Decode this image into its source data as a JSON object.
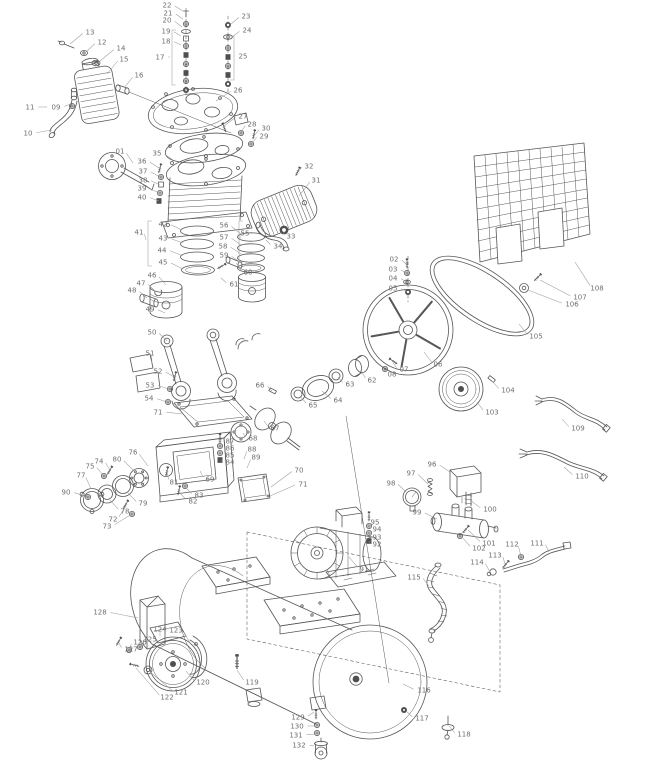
{
  "diagram": {
    "type": "exploded-parts-diagram",
    "background": "#ffffff",
    "line_color": "#565656",
    "label_color": "#6e6e6e"
  },
  "callouts": [
    {
      "n": "01",
      "lx": 120,
      "ly": 151,
      "tx": 133,
      "ty": 163
    },
    {
      "n": "02",
      "lx": 394,
      "ly": 259,
      "tx": 406,
      "ty": 264
    },
    {
      "n": "03",
      "lx": 393,
      "ly": 269,
      "tx": 406,
      "ty": 273
    },
    {
      "n": "04",
      "lx": 393,
      "ly": 278,
      "tx": 407,
      "ty": 282
    },
    {
      "n": "05",
      "lx": 393,
      "ly": 288,
      "tx": 407,
      "ty": 292
    },
    {
      "n": "06",
      "lx": 438,
      "ly": 364,
      "tx": 424,
      "ty": 352
    },
    {
      "n": "07",
      "lx": 404,
      "ly": 369,
      "tx": 393,
      "ty": 363
    },
    {
      "n": "08",
      "lx": 392,
      "ly": 374,
      "tx": 385,
      "ty": 369
    },
    {
      "n": "09",
      "lx": 56,
      "ly": 107,
      "tx": 71,
      "ty": 104
    },
    {
      "n": "10",
      "lx": 28,
      "ly": 133,
      "tx": 52,
      "ty": 130
    },
    {
      "n": "11",
      "lx": 30,
      "ly": 107,
      "tx": 47,
      "ty": 107
    },
    {
      "n": "12",
      "lx": 102,
      "ly": 42,
      "tx": 86,
      "ty": 52
    },
    {
      "n": "13",
      "lx": 90,
      "ly": 32,
      "tx": 70,
      "ty": 44
    },
    {
      "n": "14",
      "lx": 121,
      "ly": 48,
      "tx": 100,
      "ty": 61
    },
    {
      "n": "15",
      "lx": 124,
      "ly": 59,
      "tx": 107,
      "ty": 74
    },
    {
      "n": "16",
      "lx": 139,
      "ly": 75,
      "tx": 124,
      "ty": 88
    },
    {
      "n": "17",
      "lx": 160,
      "ly": 57,
      "tx": 170,
      "ty": 57
    },
    {
      "n": "18",
      "lx": 166,
      "ly": 41,
      "tx": 181,
      "ty": 45
    },
    {
      "n": "19",
      "lx": 166,
      "ly": 31,
      "tx": 181,
      "ty": 36
    },
    {
      "n": "20",
      "lx": 167,
      "ly": 20,
      "tx": 182,
      "ty": 27
    },
    {
      "n": "21",
      "lx": 168,
      "ly": 13,
      "tx": 183,
      "ty": 19
    },
    {
      "n": "22",
      "lx": 167,
      "ly": 5,
      "tx": 183,
      "ty": 11
    },
    {
      "n": "23",
      "lx": 246,
      "ly": 16,
      "tx": 230,
      "ty": 25
    },
    {
      "n": "24",
      "lx": 247,
      "ly": 30,
      "tx": 231,
      "ty": 38
    },
    {
      "n": "25",
      "lx": 243,
      "ly": 56,
      "tx": 235,
      "ty": 56
    },
    {
      "n": "26",
      "lx": 238,
      "ly": 90,
      "tx": 216,
      "ty": 101
    },
    {
      "n": "27",
      "lx": 243,
      "ly": 116,
      "tx": 224,
      "ty": 126
    },
    {
      "n": "28",
      "lx": 252,
      "ly": 124,
      "tx": 241,
      "ty": 132
    },
    {
      "n": "29",
      "lx": 264,
      "ly": 136,
      "tx": 252,
      "ty": 143
    },
    {
      "n": "30",
      "lx": 266,
      "ly": 128,
      "tx": 254,
      "ty": 136
    },
    {
      "n": "31",
      "lx": 316,
      "ly": 180,
      "tx": 299,
      "ty": 196
    },
    {
      "n": "32",
      "lx": 309,
      "ly": 166,
      "tx": 298,
      "ty": 172
    },
    {
      "n": "33",
      "lx": 291,
      "ly": 236,
      "tx": 284,
      "ty": 232
    },
    {
      "n": "34",
      "lx": 278,
      "ly": 246,
      "tx": 266,
      "ty": 240
    },
    {
      "n": "35",
      "lx": 157,
      "ly": 153,
      "tx": 173,
      "ty": 160
    },
    {
      "n": "36",
      "lx": 142,
      "ly": 161,
      "tx": 159,
      "ty": 168
    },
    {
      "n": "37",
      "lx": 143,
      "ly": 171,
      "tx": 160,
      "ty": 177
    },
    {
      "n": "38",
      "lx": 143,
      "ly": 180,
      "tx": 160,
      "ty": 185
    },
    {
      "n": "39",
      "lx": 142,
      "ly": 188,
      "tx": 159,
      "ty": 193
    },
    {
      "n": "40",
      "lx": 142,
      "ly": 197,
      "tx": 159,
      "ty": 201
    },
    {
      "n": "41",
      "lx": 139,
      "ly": 232,
      "tx": 146,
      "ty": 240
    },
    {
      "n": "42",
      "lx": 163,
      "ly": 224,
      "tx": 182,
      "ty": 230
    },
    {
      "n": "43",
      "lx": 163,
      "ly": 238,
      "tx": 183,
      "ty": 243
    },
    {
      "n": "44",
      "lx": 162,
      "ly": 250,
      "tx": 183,
      "ty": 256
    },
    {
      "n": "45",
      "lx": 163,
      "ly": 262,
      "tx": 183,
      "ty": 269
    },
    {
      "n": "46",
      "lx": 152,
      "ly": 275,
      "tx": 166,
      "ty": 285
    },
    {
      "n": "47",
      "lx": 141,
      "ly": 283,
      "tx": 156,
      "ty": 292
    },
    {
      "n": "48",
      "lx": 132,
      "ly": 290,
      "tx": 147,
      "ty": 298
    },
    {
      "n": "49",
      "lx": 150,
      "ly": 309,
      "tx": 165,
      "ty": 313
    },
    {
      "n": "50",
      "lx": 152,
      "ly": 332,
      "tx": 167,
      "ty": 341
    },
    {
      "n": "51",
      "lx": 150,
      "ly": 353,
      "tx": 152,
      "ty": 363
    },
    {
      "n": "52",
      "lx": 158,
      "ly": 371,
      "tx": 174,
      "ty": 377
    },
    {
      "n": "53",
      "lx": 150,
      "ly": 385,
      "tx": 169,
      "ty": 389
    },
    {
      "n": "54",
      "lx": 149,
      "ly": 398,
      "tx": 167,
      "ty": 402
    },
    {
      "n": "55",
      "lx": 245,
      "ly": 233,
      "tx": 240,
      "ty": 240
    },
    {
      "n": "56",
      "lx": 224,
      "ly": 225,
      "tx": 241,
      "ty": 234
    },
    {
      "n": "57",
      "lx": 224,
      "ly": 237,
      "tx": 241,
      "ty": 245
    },
    {
      "n": "58",
      "lx": 223,
      "ly": 246,
      "tx": 241,
      "ty": 254
    },
    {
      "n": "59",
      "lx": 224,
      "ly": 255,
      "tx": 241,
      "ty": 263
    },
    {
      "n": "60",
      "lx": 248,
      "ly": 272,
      "tx": 236,
      "ty": 263
    },
    {
      "n": "61",
      "lx": 234,
      "ly": 284,
      "tx": 221,
      "ty": 278
    },
    {
      "n": "62",
      "lx": 372,
      "ly": 380,
      "tx": 361,
      "ty": 371
    },
    {
      "n": "63",
      "lx": 350,
      "ly": 384,
      "tx": 338,
      "ty": 377
    },
    {
      "n": "64",
      "lx": 338,
      "ly": 400,
      "tx": 322,
      "ty": 391
    },
    {
      "n": "65",
      "lx": 313,
      "ly": 405,
      "tx": 300,
      "ty": 396
    },
    {
      "n": "66",
      "lx": 260,
      "ly": 385,
      "tx": 272,
      "ty": 391
    },
    {
      "n": "67",
      "lx": 275,
      "ly": 428,
      "tx": 264,
      "ty": 421
    },
    {
      "n": "68",
      "lx": 253,
      "ly": 438,
      "tx": 243,
      "ty": 433
    },
    {
      "n": "69",
      "lx": 210,
      "ly": 479,
      "tx": 200,
      "ty": 471
    },
    {
      "n": "70",
      "lx": 299,
      "ly": 470,
      "tx": 271,
      "ty": 487
    },
    {
      "n": "71",
      "lx": 303,
      "ly": 484,
      "tx": 270,
      "ty": 496
    },
    {
      "n": "71",
      "lx": 158,
      "ly": 412,
      "tx": 182,
      "ty": 414
    },
    {
      "n": "72",
      "lx": 113,
      "ly": 519,
      "tx": 126,
      "ty": 506
    },
    {
      "n": "73",
      "lx": 107,
      "ly": 526,
      "tx": 132,
      "ty": 514
    },
    {
      "n": "74",
      "lx": 99,
      "ly": 461,
      "tx": 110,
      "ty": 470
    },
    {
      "n": "75",
      "lx": 90,
      "ly": 466,
      "tx": 104,
      "ty": 476
    },
    {
      "n": "76",
      "lx": 133,
      "ly": 452,
      "tx": 148,
      "ty": 466
    },
    {
      "n": "77",
      "lx": 81,
      "ly": 475,
      "tx": 91,
      "ty": 489
    },
    {
      "n": "78",
      "lx": 125,
      "ly": 511,
      "tx": 110,
      "ty": 500
    },
    {
      "n": "79",
      "lx": 143,
      "ly": 503,
      "tx": 127,
      "ty": 492
    },
    {
      "n": "80",
      "lx": 117,
      "ly": 459,
      "tx": 136,
      "ty": 473
    },
    {
      "n": "81",
      "lx": 174,
      "ly": 482,
      "tx": 167,
      "ty": 473
    },
    {
      "n": "82",
      "lx": 193,
      "ly": 501,
      "tx": 179,
      "ty": 492
    },
    {
      "n": "83",
      "lx": 199,
      "ly": 495,
      "tx": 185,
      "ty": 487
    },
    {
      "n": "84",
      "lx": 230,
      "ly": 462,
      "tx": 221,
      "ty": 460
    },
    {
      "n": "85",
      "lx": 230,
      "ly": 455,
      "tx": 221,
      "ty": 453
    },
    {
      "n": "86",
      "lx": 230,
      "ly": 448,
      "tx": 221,
      "ty": 446
    },
    {
      "n": "87",
      "lx": 230,
      "ly": 441,
      "tx": 221,
      "ty": 439
    },
    {
      "n": "88",
      "lx": 252,
      "ly": 449,
      "tx": 244,
      "ty": 459
    },
    {
      "n": "89",
      "lx": 256,
      "ly": 457,
      "tx": 247,
      "ty": 468
    },
    {
      "n": "90",
      "lx": 66,
      "ly": 492,
      "tx": 88,
      "ty": 497
    },
    {
      "n": "91",
      "lx": 364,
      "ly": 569,
      "tx": 349,
      "ty": 557
    },
    {
      "n": "92",
      "lx": 377,
      "ly": 544,
      "tx": 370,
      "ty": 541
    },
    {
      "n": "93",
      "lx": 377,
      "ly": 537,
      "tx": 370,
      "ty": 533
    },
    {
      "n": "94",
      "lx": 377,
      "ly": 529,
      "tx": 370,
      "ty": 526
    },
    {
      "n": "95",
      "lx": 375,
      "ly": 522,
      "tx": 369,
      "ty": 518
    },
    {
      "n": "96",
      "lx": 432,
      "ly": 464,
      "tx": 450,
      "ty": 472
    },
    {
      "n": "97",
      "lx": 411,
      "ly": 473,
      "tx": 428,
      "ty": 484
    },
    {
      "n": "98",
      "lx": 391,
      "ly": 483,
      "tx": 406,
      "ty": 492
    },
    {
      "n": "99",
      "lx": 417,
      "ly": 512,
      "tx": 437,
      "ty": 519
    },
    {
      "n": "100",
      "lx": 490,
      "ly": 509,
      "tx": 470,
      "ty": 500
    },
    {
      "n": "101",
      "lx": 489,
      "ly": 543,
      "tx": 468,
      "ty": 530
    },
    {
      "n": "102",
      "lx": 479,
      "ly": 548,
      "tx": 461,
      "ty": 536
    },
    {
      "n": "103",
      "lx": 492,
      "ly": 412,
      "tx": 477,
      "ty": 402
    },
    {
      "n": "104",
      "lx": 508,
      "ly": 390,
      "tx": 492,
      "ty": 381
    },
    {
      "n": "105",
      "lx": 536,
      "ly": 336,
      "tx": 519,
      "ty": 324
    },
    {
      "n": "106",
      "lx": 572,
      "ly": 304,
      "tx": 528,
      "ty": 290
    },
    {
      "n": "107",
      "lx": 580,
      "ly": 297,
      "tx": 540,
      "ty": 280
    },
    {
      "n": "108",
      "lx": 597,
      "ly": 288,
      "tx": 575,
      "ty": 262
    },
    {
      "n": "109",
      "lx": 578,
      "ly": 428,
      "tx": 562,
      "ty": 419
    },
    {
      "n": "110",
      "lx": 582,
      "ly": 476,
      "tx": 564,
      "ty": 467
    },
    {
      "n": "111",
      "lx": 537,
      "ly": 543,
      "tx": 549,
      "ty": 552
    },
    {
      "n": "112",
      "lx": 512,
      "ly": 544,
      "tx": 521,
      "ty": 556
    },
    {
      "n": "113",
      "lx": 495,
      "ly": 555,
      "tx": 505,
      "ty": 564
    },
    {
      "n": "114",
      "lx": 477,
      "ly": 562,
      "tx": 490,
      "ty": 572
    },
    {
      "n": "115",
      "lx": 414,
      "ly": 577,
      "tx": 429,
      "ty": 586
    },
    {
      "n": "116",
      "lx": 424,
      "ly": 690,
      "tx": 403,
      "ty": 684
    },
    {
      "n": "117",
      "lx": 422,
      "ly": 718,
      "tx": 406,
      "ty": 711
    },
    {
      "n": "118",
      "lx": 464,
      "ly": 734,
      "tx": 449,
      "ty": 726
    },
    {
      "n": "119",
      "lx": 252,
      "ly": 682,
      "tx": 237,
      "ty": 670
    },
    {
      "n": "120",
      "lx": 203,
      "ly": 682,
      "tx": 186,
      "ty": 671
    },
    {
      "n": "121",
      "lx": 181,
      "ly": 692,
      "tx": 149,
      "ty": 671
    },
    {
      "n": "122",
      "lx": 167,
      "ly": 697,
      "tx": 136,
      "ty": 668
    },
    {
      "n": "123",
      "lx": 176,
      "ly": 630,
      "tx": 190,
      "ty": 643
    },
    {
      "n": "124",
      "lx": 160,
      "ly": 629,
      "tx": 160,
      "ty": 636
    },
    {
      "n": "125",
      "lx": 150,
      "ly": 639,
      "tx": 140,
      "ty": 647
    },
    {
      "n": "126",
      "lx": 140,
      "ly": 642,
      "tx": 129,
      "ty": 650
    },
    {
      "n": "127",
      "lx": 131,
      "ly": 649,
      "tx": 119,
      "ty": 643
    },
    {
      "n": "128",
      "lx": 100,
      "ly": 612,
      "tx": 138,
      "ty": 618
    },
    {
      "n": "129",
      "lx": 298,
      "ly": 717,
      "tx": 314,
      "ty": 712
    },
    {
      "n": "130",
      "lx": 297,
      "ly": 726,
      "tx": 315,
      "ty": 726
    },
    {
      "n": "131",
      "lx": 296,
      "ly": 735,
      "tx": 315,
      "ty": 734
    },
    {
      "n": "132",
      "lx": 299,
      "ly": 745,
      "tx": 314,
      "ty": 746
    }
  ],
  "brackets": [
    {
      "for": "17",
      "x": 172,
      "y1": 30,
      "y2": 85,
      "dir": 1
    },
    {
      "for": "25",
      "x": 234,
      "y1": 36,
      "y2": 80,
      "dir": -1
    },
    {
      "for": "41",
      "x": 148,
      "y1": 221,
      "y2": 266,
      "dir": 1
    },
    {
      "for": "55",
      "x": 239,
      "y1": 221,
      "y2": 262,
      "dir": 1
    }
  ]
}
